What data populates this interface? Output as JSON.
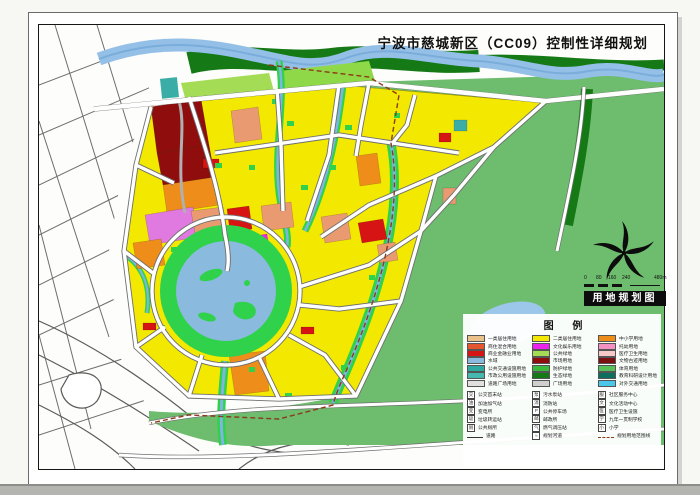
{
  "page": {
    "title": "宁波市慈城新区（CC09）控制性详细规划"
  },
  "map_label": {
    "text": "用地规划图"
  },
  "scale_bar": {
    "labels": [
      "0",
      "80",
      "160",
      "240",
      "480m"
    ]
  },
  "legend": {
    "title": "图 例",
    "color_items": [
      {
        "label": "一类居住用地",
        "color": "#e9c189"
      },
      {
        "label": "商住混合用地",
        "color": "#e4572e"
      },
      {
        "label": "商业金融业用地",
        "color": "#d61414"
      },
      {
        "label": "水域",
        "color": "#8abade"
      },
      {
        "label": "公共交通设施用地",
        "color": "#2fa8a0"
      },
      {
        "label": "市政公用设施用地",
        "color": "#45b8b0"
      },
      {
        "label": "道路广场用地",
        "color": "#e0e0e0"
      },
      {
        "label": "二类居住用地",
        "color": "#f2e800"
      },
      {
        "label": "文化娱乐用地",
        "color": "#ee22ee"
      },
      {
        "label": "公共绿地",
        "color": "#a4dc55"
      },
      {
        "label": "市场用地",
        "color": "#8f0d0d"
      },
      {
        "label": "防护绿地",
        "color": "#3cb83c"
      },
      {
        "label": "生态绿地",
        "color": "#157a15"
      },
      {
        "label": "广场用地",
        "color": "#cfcfcf"
      },
      {
        "label": "中小学用地",
        "color": "#ef8d1a"
      },
      {
        "label": "托幼用地",
        "color": "#f591c2"
      },
      {
        "label": "医疗卫生用地",
        "color": "#f7c8c8"
      },
      {
        "label": "文物古迹用地",
        "color": "#7a1010"
      },
      {
        "label": "体育用地",
        "color": "#58c058"
      },
      {
        "label": "教育科研设计用地",
        "color": "#0e6e5e"
      },
      {
        "label": "对外交通用地",
        "color": "#49c8e8"
      }
    ],
    "symbol_items": [
      {
        "label": "公交首末站",
        "glyph": "交",
        "kind": "box"
      },
      {
        "label": "加油加气站",
        "glyph": "油",
        "kind": "box"
      },
      {
        "label": "变电所",
        "glyph": "变",
        "kind": "box"
      },
      {
        "label": "垃圾转运站",
        "glyph": "圾",
        "kind": "box"
      },
      {
        "label": "公共厕所",
        "glyph": "厕",
        "kind": "box"
      },
      {
        "label": "道路",
        "glyph": "",
        "kind": "line"
      },
      {
        "label": "污水泵站",
        "glyph": "泵",
        "kind": "box"
      },
      {
        "label": "消防站",
        "glyph": "消",
        "kind": "box"
      },
      {
        "label": "公共停车场",
        "glyph": "P",
        "kind": "box"
      },
      {
        "label": "邮政所",
        "glyph": "邮",
        "kind": "box"
      },
      {
        "label": "燃气调压站",
        "glyph": "气",
        "kind": "box"
      },
      {
        "label": "规划河道",
        "glyph": "≈",
        "kind": "box"
      },
      {
        "label": "社区服务中心",
        "glyph": "服",
        "kind": "box"
      },
      {
        "label": "文化活动中心",
        "glyph": "文",
        "kind": "box"
      },
      {
        "label": "医疗卫生设施",
        "glyph": "医",
        "kind": "box"
      },
      {
        "label": "九年一贯制学校",
        "glyph": "学",
        "kind": "box"
      },
      {
        "label": "小学",
        "glyph": "小",
        "kind": "box"
      },
      {
        "label": "规划用地范围线",
        "glyph": "",
        "kind": "dash"
      }
    ]
  },
  "colors": {
    "residential_yellow": "#f2e800",
    "commercial_red": "#d61414",
    "commercial_dark_red": "#8f0d0d",
    "school_orange": "#ef8d1a",
    "culture_magenta": "#ee22ee",
    "office_salmon": "#ea9a70",
    "violet": "#e07ae0",
    "utility_teal": "#3aaea6",
    "park_light_green": "#a4dc55",
    "ring_green": "#2fd24a",
    "eco_green": "#6ebc6e",
    "shelter_dark_green": "#157a15",
    "water_blue": "#94c0e8",
    "boundary_brown": "#8b3a1a"
  }
}
